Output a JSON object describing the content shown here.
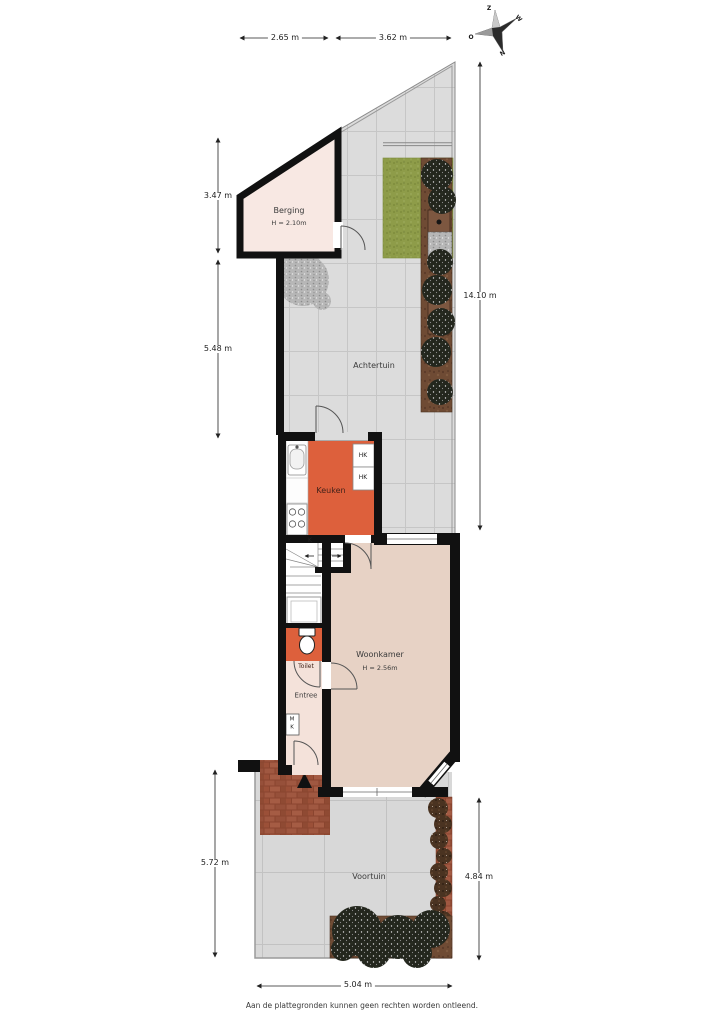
{
  "footer": "Aan de plattegronden kunnen geen rechten worden ontleend.",
  "compass": {
    "top": "Z",
    "left": "O",
    "upper_right": "W",
    "bottom": "N"
  },
  "rooms": {
    "berging": {
      "name": "Berging",
      "height": "H = 2.10m"
    },
    "achtertuin": {
      "name": "Achtertuin"
    },
    "keuken": {
      "name": "Keuken"
    },
    "woonkamer": {
      "name": "Woonkamer",
      "height": "H = 2.56m"
    },
    "toilet": {
      "name": "Toilet"
    },
    "entree": {
      "name": "Entree"
    },
    "voortuin": {
      "name": "Voortuin"
    }
  },
  "labels": {
    "hk_top": "HK",
    "hk_bottom": "HK",
    "stair": "K",
    "meter_m": "M",
    "meter_k": "K"
  },
  "dimensions": {
    "top_left": "2.65 m",
    "top_right": "3.62 m",
    "left_berging": "3.47 m",
    "left_achtertuin": "5.48 m",
    "right_achtertuin": "14.10 m",
    "left_voortuin": "5.72 m",
    "right_voortuin": "4.84 m",
    "bottom_voortuin": "5.04 m"
  },
  "colors": {
    "wall": "#111111",
    "kitchen_orange": "#dd603c",
    "living_beige": "#e7d2c5",
    "berging_pink": "#f8e8e3",
    "entree_pink": "#f4e2da",
    "tile_gray": "#dcdcdc",
    "grass_green": "#8e9c49",
    "soil_brown": "#6f4b34",
    "brick_red": "#9a5138"
  }
}
